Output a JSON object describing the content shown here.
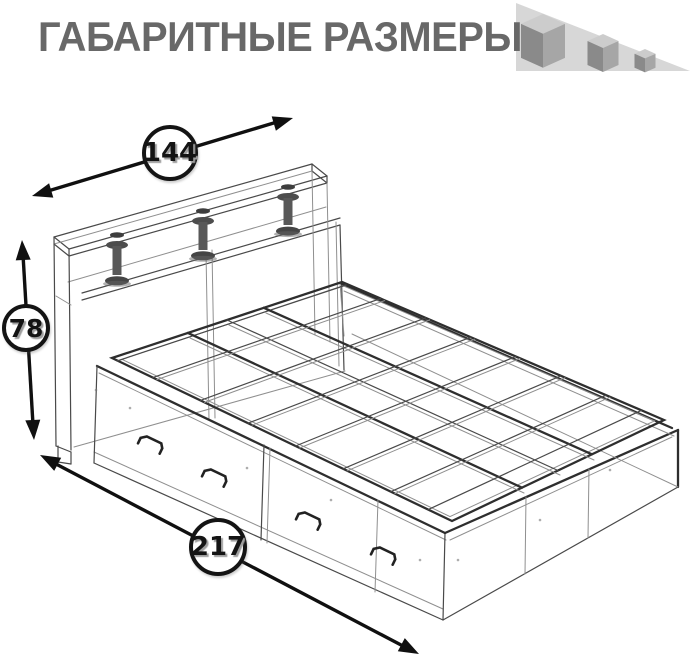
{
  "title": "ГАБАРИТНЫЕ РАЗМЕРЫ",
  "dimensions": {
    "width": "144",
    "height": "78",
    "length": "217"
  },
  "icon": {
    "name": "decreasing-cubes"
  },
  "colors": {
    "title_text": "#686868",
    "dimension_text": "#141414",
    "arrow": "#101010",
    "sketch_line": "#4a4a4a",
    "icon_triangle": "#d7d7d7",
    "cube_top": "#cccccc",
    "cube_left": "#8a8a8a",
    "cube_right": "#a6a6a6"
  }
}
